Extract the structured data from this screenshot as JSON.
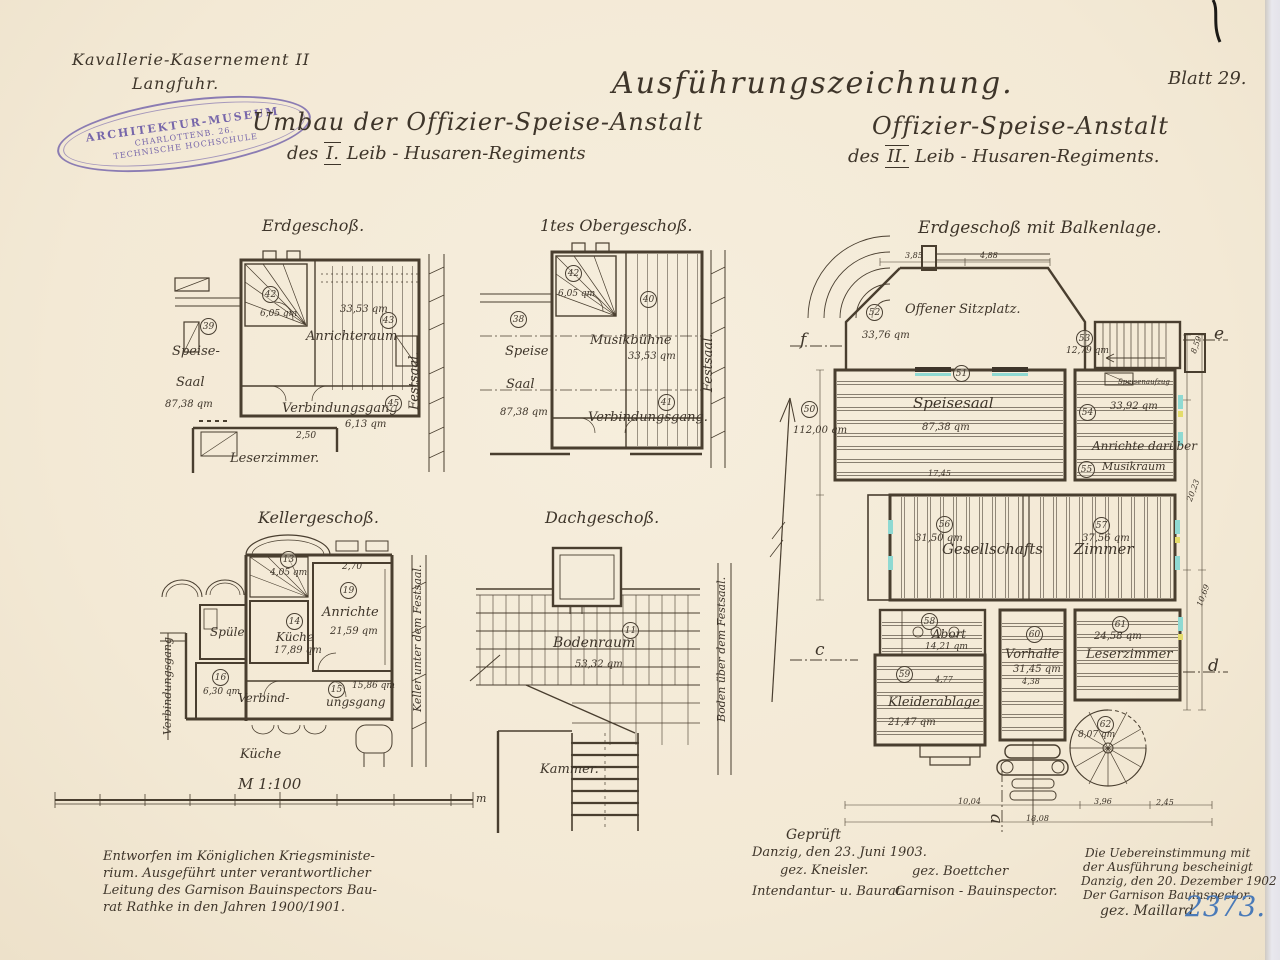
{
  "header": {
    "site_line1": "Kavallerie-Kasernement II",
    "site_line2": "Langfuhr.",
    "drawing_type": "Ausführungszeichnung.",
    "sheet": "Blatt 29.",
    "left_title": {
      "line1": "Umbau der Offizier-Speise-Anstalt",
      "prefix": "des",
      "numeral": "I.",
      "suffix": "Leib - Husaren-Regiments"
    },
    "right_title": {
      "line1": "Offizier-Speise-Anstalt",
      "prefix": "des",
      "numeral": "II.",
      "suffix": "Leib - Husaren-Regiments."
    }
  },
  "stamp": {
    "line1": "ARCHITEKTUR-MUSEUM",
    "line2": "CHARLOTTENB. 26.",
    "line3": "TECHNISCHE HOCHSCHULE"
  },
  "plans": {
    "erdgeschoss": {
      "title": "Erdgeschoß.",
      "speise1": "Speise-",
      "speise2": "Saal",
      "speise_area": "87,38 qm",
      "speise_num": "39",
      "stair_num": "42",
      "stair_area": "6,05 qm",
      "anrichteraum": "Anrichteraum",
      "anrichteraum_area": "33,53 qm",
      "anrichteraum_num": "43",
      "gang": "Verbindungsgang",
      "gang_area": "6,13 qm",
      "gang_num": "45",
      "leserzimmer": "Leserzimmer.",
      "festsaal": "Festsaal.",
      "dim1": "2,50"
    },
    "obergeschoss": {
      "title": "1tes Obergeschoß.",
      "speise1": "Speise",
      "speise2": "Saal",
      "speise_area": "87,38 qm",
      "speise_num": "38",
      "stair_num": "42",
      "stair_area": "6,05 qm",
      "musik": "Musikbühne",
      "musik_area": "33,53 qm",
      "musik_num": "40",
      "gang": "Verbindungsgang.",
      "gang_num": "41",
      "festsaal": "Festsaal."
    },
    "keller": {
      "title": "Kellergeschoß.",
      "stair_num": "13",
      "stair_area": "4,05 qm",
      "kueche": "Küche",
      "kueche_area": "17,89 qm",
      "kueche_num": "14",
      "spuele": "Spüle",
      "anrichte": "Anrichte",
      "anrichte_area": "21,59 qm",
      "anrichte_num": "19",
      "dim1": "2,70",
      "raum_num": "16",
      "raum_area": "6,30 qm",
      "gang1": "Verbind-",
      "gang2": "ungsgang",
      "gang_area": "15,86 qm",
      "gang_num": "15",
      "kueche_unten": "Küche",
      "gang_vert": "Verbindungsgang",
      "keller_vert": "Keller unter dem Festsaal."
    },
    "dach": {
      "title": "Dachgeschoß.",
      "boden": "Bodenraum",
      "boden_area": "53,32 qm",
      "boden_num": "11",
      "kammer": "Kammer.",
      "boden_vert": "Boden über dem Festsaal."
    },
    "balkenlage": {
      "title": "Erdgeschoß mit Balkenlage.",
      "sitzplatz": "Offener Sitzplatz.",
      "sitzplatz_area": "33,76 qm",
      "sitzplatz_num": "52",
      "terrasse_num": "50",
      "terrasse_area": "112,00 qm",
      "stair_num": "53",
      "stair_area": "12,79 qm",
      "speisesaal": "Speisesaal",
      "speisesaal_area": "87,38 qm",
      "speisesaal_num": "51",
      "anrichte_num": "54",
      "anrichte_area": "33,92 qm",
      "anrichte": "Anrichte darüber",
      "musik": "Musikraum",
      "musik_num": "55",
      "aufzug": "Speisenaufzug",
      "gesellschaft": "Gesellschafts Zimmer",
      "g_left_num": "56",
      "g_left_area": "31,50 qm",
      "g_right_num": "57",
      "g_right_area": "37,56 qm",
      "abort": "Abort",
      "abort_area": "14,21 qm",
      "abort_num": "58",
      "kleider": "Kleiderablage",
      "kleider_area": "21,47 qm",
      "kleider_num": "59",
      "dim_kl": "4,77",
      "vorhalle": "Vorhalle",
      "vorhalle_area": "31,45 qm",
      "vorhalle_num": "60",
      "dim_vh": "4,38",
      "leser": "Leserzimmer",
      "leser_area": "24,58 qm",
      "leser_num": "61",
      "wendel_num": "62",
      "wendel_area": "8,07 qm",
      "sec_a": "a",
      "sec_c": "c",
      "sec_d": "d",
      "sec_e": "e",
      "sec_f": "f",
      "dim_top1": "3,85",
      "dim_top2": "4,88",
      "dim_r1": "8,59",
      "dim_r2": "20,23",
      "dim_r3": "10,69",
      "dim_b1": "10,04",
      "dim_b2": "3,96",
      "dim_b3": "2,45",
      "dim_b4": "18,08",
      "dim_ss": "17,45"
    }
  },
  "scale": {
    "label": "M 1:100",
    "unit_right": "m"
  },
  "footer": {
    "left1": "Entworfen im Königlichen Kriegsministe-",
    "left2": "rium. Ausgeführt unter verantwortlicher",
    "left3": "Leitung des Garnison Bauinspectors Bau-",
    "left4": "rat Rathke in den Jahren 1900/1901.",
    "center_title": "Geprüft",
    "center_place": "Danzig, den 23. Juni 1903.",
    "sig_left": "gez. Kneisler.",
    "sig_right": "gez. Boettcher",
    "role_left": "Intendantur- u. Baurat.",
    "role_right": "Garnison - Bauinspector.",
    "right1": "Die Uebereinstimmung mit",
    "right2": "der Ausführung bescheinigt",
    "right3": "Danzig, den 20. Dezember 1902",
    "right4": "Der Garnison Bauinspector.",
    "right5": "gez. Maillard",
    "archive_number": "2373."
  },
  "colors": {
    "paper": "#f4ecda",
    "ink": "#3e352a",
    "stamp_purple": "#7b6aae",
    "number_blue": "#4a7ab8",
    "highlight_cyan": "#8fd9d2",
    "highlight_yellow": "#e4dc6b"
  }
}
